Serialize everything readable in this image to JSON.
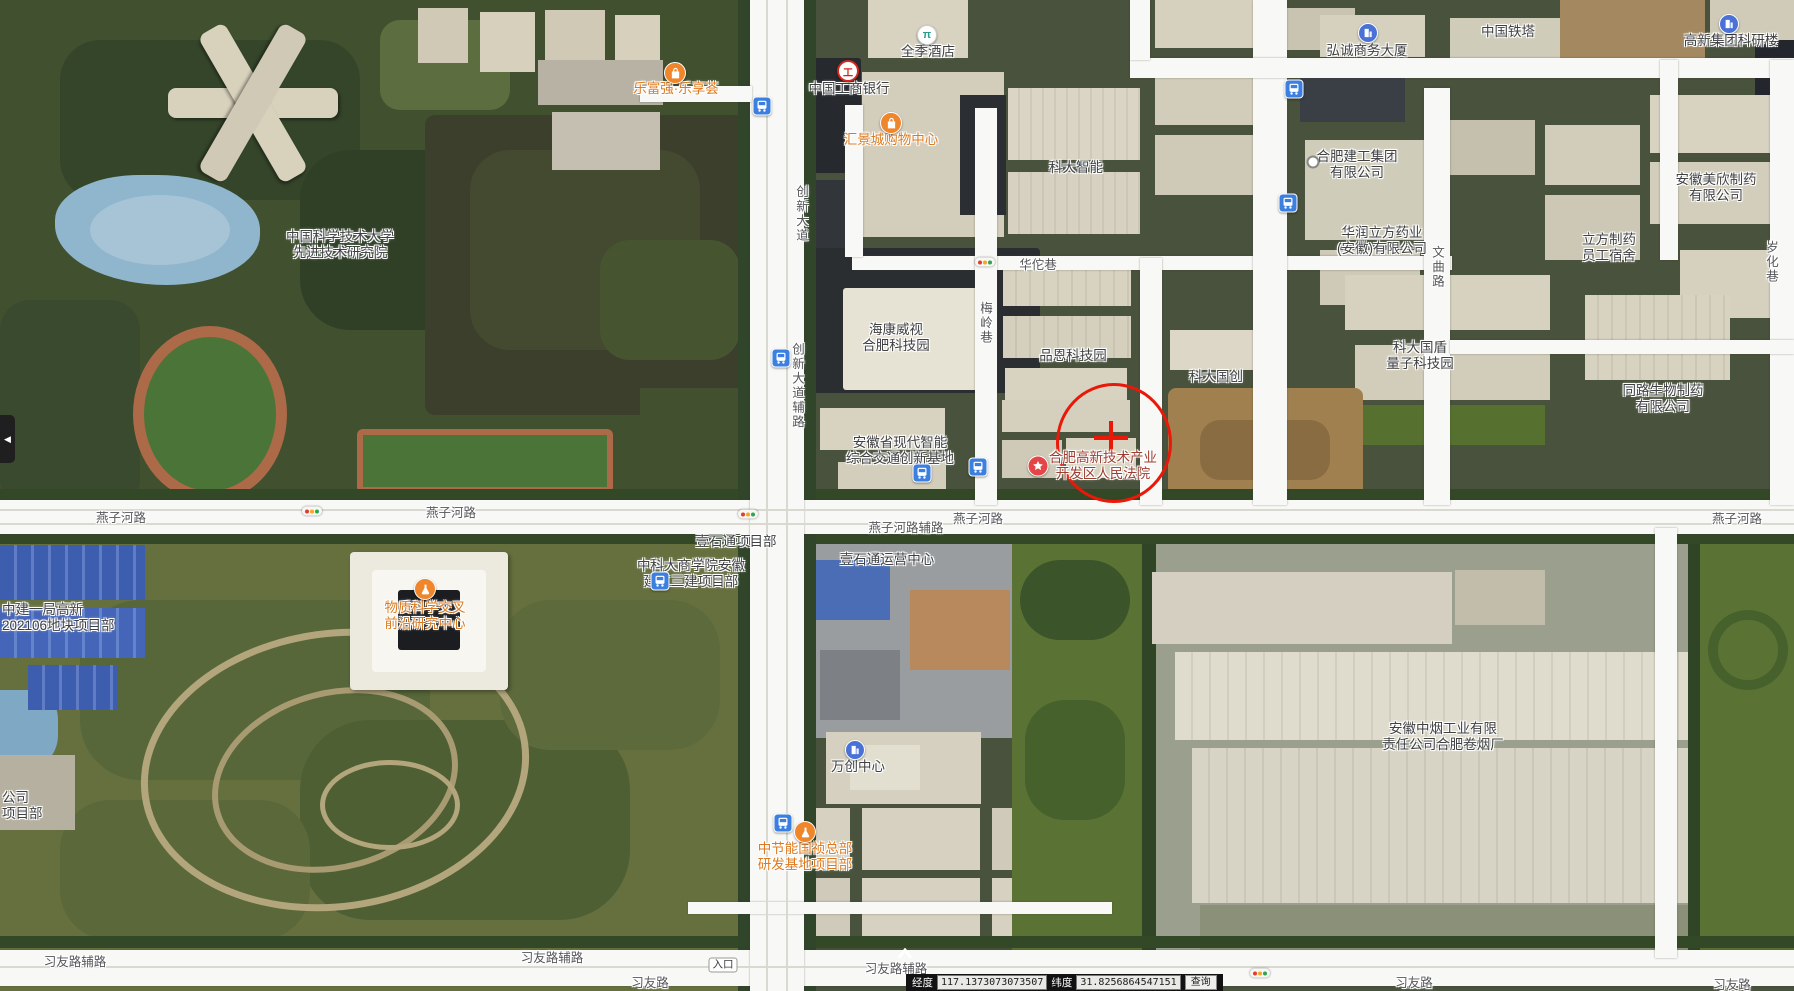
{
  "map": {
    "colors": {
      "poi_orange": "#dd7a1e",
      "gov_red": "#9e3c30",
      "annotation_red": "#ea1808",
      "road_white": "#f8f8f6",
      "transit_blue": "#3b7fe0"
    },
    "place_labels": [
      {
        "lines": [
          "中国科学技术大学",
          "先进技术研究院"
        ],
        "x": 340,
        "y": 245
      },
      {
        "lines": [
          "乐富强·乐享荟"
        ],
        "x": 676,
        "y": 89,
        "style": "shop"
      },
      {
        "lines": [
          "全季酒店"
        ],
        "x": 928,
        "y": 52
      },
      {
        "lines": [
          "中国工商银行"
        ],
        "x": 849,
        "y": 89
      },
      {
        "lines": [
          "汇景城购物中心"
        ],
        "x": 891,
        "y": 140,
        "style": "shop"
      },
      {
        "lines": [
          "科大智能"
        ],
        "x": 1076,
        "y": 168
      },
      {
        "lines": [
          "弘诚商务大厦"
        ],
        "x": 1367,
        "y": 51
      },
      {
        "lines": [
          "中国铁塔"
        ],
        "x": 1508,
        "y": 32
      },
      {
        "lines": [
          "高新集团科研楼"
        ],
        "x": 1731,
        "y": 41
      },
      {
        "lines": [
          "合肥建工集团",
          "有限公司"
        ],
        "x": 1357,
        "y": 165
      },
      {
        "lines": [
          "华润立方药业",
          "(安徽)有限公司"
        ],
        "x": 1382,
        "y": 241
      },
      {
        "lines": [
          "立方制药",
          "员工宿舍"
        ],
        "x": 1609,
        "y": 248
      },
      {
        "lines": [
          "安徽美欣制药",
          "有限公司"
        ],
        "x": 1716,
        "y": 188
      },
      {
        "lines": [
          "科大国盾",
          "量子科技园"
        ],
        "x": 1420,
        "y": 356
      },
      {
        "lines": [
          "同路生物制药",
          "有限公司"
        ],
        "x": 1663,
        "y": 399
      },
      {
        "lines": [
          "海康威视",
          "合肥科技园"
        ],
        "x": 896,
        "y": 338
      },
      {
        "lines": [
          "品恩科技园"
        ],
        "x": 1073,
        "y": 356
      },
      {
        "lines": [
          "科大国创"
        ],
        "x": 1216,
        "y": 377
      },
      {
        "lines": [
          "安徽省现代智能",
          "综合交通创新基地"
        ],
        "x": 900,
        "y": 451
      },
      {
        "lines": [
          "合肥高新技术产业",
          "开发区人民法院"
        ],
        "x": 1103,
        "y": 466,
        "style": "gov"
      },
      {
        "lines": [
          "物质科学交叉",
          "前沿研究中心"
        ],
        "x": 425,
        "y": 616,
        "style": "shop"
      },
      {
        "lines": [
          "中建一局高新",
          "202106地块项目部"
        ],
        "x": 2,
        "y": 618,
        "align": "left"
      },
      {
        "lines": [
          "中科大商学院安徽",
          "建工三建项目部"
        ],
        "x": 691,
        "y": 574
      },
      {
        "lines": [
          "壹石通项目部"
        ],
        "x": 736,
        "y": 542
      },
      {
        "lines": [
          "壹石通运营中心"
        ],
        "x": 887,
        "y": 560
      },
      {
        "lines": [
          "万创中心"
        ],
        "x": 858,
        "y": 767
      },
      {
        "lines": [
          "中节能国祯总部",
          "研发基地项目部"
        ],
        "x": 805,
        "y": 857,
        "style": "shop"
      },
      {
        "lines": [
          "安徽中烟工业有限",
          "责任公司合肥卷烟厂"
        ],
        "x": 1443,
        "y": 737
      },
      {
        "lines": [
          "公司",
          "项目部"
        ],
        "x": 2,
        "y": 806,
        "align": "left"
      },
      {
        "lines": [
          "入口"
        ],
        "x": 723,
        "y": 965,
        "style": "badge"
      }
    ],
    "road_labels": [
      {
        "text": "燕子河路",
        "x": 121,
        "y": 518
      },
      {
        "text": "燕子河路",
        "x": 451,
        "y": 513
      },
      {
        "text": "燕子河路",
        "x": 978,
        "y": 519
      },
      {
        "text": "燕子河路",
        "x": 1737,
        "y": 519
      },
      {
        "text": "燕子河路辅路",
        "x": 906,
        "y": 528
      },
      {
        "text": "华佗巷",
        "x": 1038,
        "y": 265
      },
      {
        "text": "梅岭巷",
        "x": 985,
        "y": 323,
        "vertical": true
      },
      {
        "text": "创新大道",
        "x": 801,
        "y": 214,
        "vertical": true
      },
      {
        "text": "创新大道辅路",
        "x": 797,
        "y": 386,
        "vertical": true
      },
      {
        "text": "文曲路",
        "x": 1437,
        "y": 267,
        "vertical": true
      },
      {
        "text": "岁化巷",
        "x": 1771,
        "y": 262,
        "vertical": true
      },
      {
        "text": "习友路辅路",
        "x": 75,
        "y": 962
      },
      {
        "text": "习友路辅路",
        "x": 552,
        "y": 958
      },
      {
        "text": "习友路辅路",
        "x": 896,
        "y": 969
      },
      {
        "text": "习友路",
        "x": 650,
        "y": 983
      },
      {
        "text": "习友路",
        "x": 1414,
        "y": 983
      },
      {
        "text": "习友路",
        "x": 1732,
        "y": 985
      }
    ],
    "markers": [
      {
        "type": "bag",
        "x": 675,
        "y": 73
      },
      {
        "type": "bag",
        "x": 891,
        "y": 123
      },
      {
        "type": "hotel",
        "x": 927,
        "y": 35
      },
      {
        "type": "bank",
        "x": 848,
        "y": 71
      },
      {
        "type": "bldg",
        "x": 1368,
        "y": 33
      },
      {
        "type": "bldg",
        "x": 1729,
        "y": 24
      },
      {
        "type": "bldg",
        "x": 855,
        "y": 750
      },
      {
        "type": "star",
        "x": 1038,
        "y": 466
      },
      {
        "type": "flask",
        "x": 425,
        "y": 589
      },
      {
        "type": "flask",
        "x": 805,
        "y": 832
      },
      {
        "type": "bus",
        "x": 762,
        "y": 106
      },
      {
        "type": "bus",
        "x": 1294,
        "y": 89
      },
      {
        "type": "bus",
        "x": 1288,
        "y": 203
      },
      {
        "type": "bus",
        "x": 781,
        "y": 358
      },
      {
        "type": "bus",
        "x": 922,
        "y": 473
      },
      {
        "type": "bus",
        "x": 978,
        "y": 467
      },
      {
        "type": "bus",
        "x": 660,
        "y": 581
      },
      {
        "type": "bus",
        "x": 783,
        "y": 823
      },
      {
        "type": "traffic",
        "x": 985,
        "y": 262
      },
      {
        "type": "traffic",
        "x": 312,
        "y": 511
      },
      {
        "type": "traffic",
        "x": 748,
        "y": 514
      },
      {
        "type": "traffic",
        "x": 1260,
        "y": 973
      },
      {
        "type": "dot",
        "x": 1313,
        "y": 162
      },
      {
        "type": "chevron",
        "x": 905,
        "y": 954
      }
    ],
    "annotation_circle": {
      "cx": 1111,
      "cy": 440,
      "rx": 55,
      "ry": 57
    }
  },
  "status_bar": {
    "lon_label": "经度",
    "lon_value": "117.1373073073507",
    "lat_label": "纬度",
    "lat_value": "31.8256864547151",
    "query_label": "查询"
  },
  "ui": {
    "collapse_icon": "◀"
  }
}
